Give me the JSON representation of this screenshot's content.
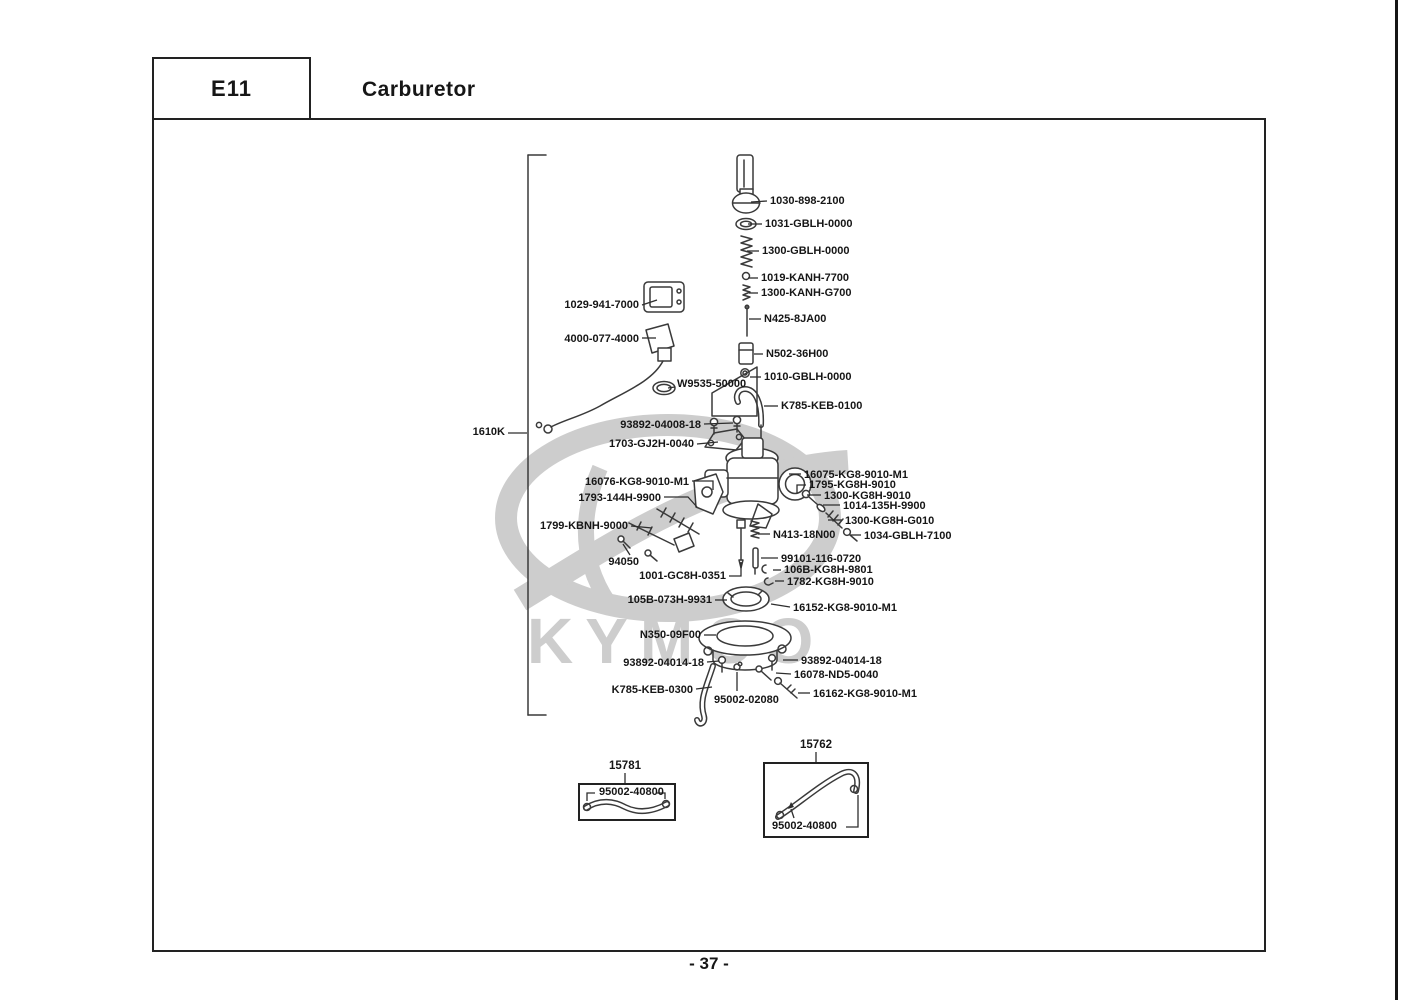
{
  "page": {
    "section_code": "E11",
    "title": "Carburetor",
    "page_number": "- 37 -",
    "watermark_text": "KYMCO"
  },
  "part_labels": [
    {
      "text": "1030-898-2100",
      "x": 770,
      "y": 195,
      "leader": [
        [
          767,
          201
        ],
        [
          751,
          202
        ]
      ]
    },
    {
      "text": "1031-GBLH-0000",
      "x": 765,
      "y": 218,
      "leader": [
        [
          762,
          224
        ],
        [
          748,
          224
        ]
      ]
    },
    {
      "text": "1300-GBLH-0000",
      "x": 762,
      "y": 245,
      "leader": [
        [
          759,
          251
        ],
        [
          747,
          251
        ]
      ]
    },
    {
      "text": "1019-KANH-7700",
      "x": 761,
      "y": 272,
      "leader": [
        [
          758,
          278
        ],
        [
          748,
          278
        ]
      ]
    },
    {
      "text": "1300-KANH-G700",
      "x": 761,
      "y": 287,
      "leader": [
        [
          758,
          293
        ],
        [
          749,
          293
        ]
      ]
    },
    {
      "text": "N425-8JA00",
      "x": 764,
      "y": 313,
      "leader": [
        [
          761,
          319
        ],
        [
          749,
          319
        ]
      ]
    },
    {
      "text": "N502-36H00",
      "x": 766,
      "y": 348,
      "leader": [
        [
          763,
          354
        ],
        [
          754,
          354
        ]
      ]
    },
    {
      "text": "1010-GBLH-0000",
      "x": 764,
      "y": 371,
      "leader": [
        [
          761,
          377
        ],
        [
          750,
          377
        ]
      ]
    },
    {
      "text": "K785-KEB-0100",
      "x": 781,
      "y": 400,
      "leader": [
        [
          778,
          406
        ],
        [
          764,
          406
        ]
      ]
    },
    {
      "text": "1029-941-7000",
      "x": 639,
      "y": 299,
      "align": "right",
      "leader": [
        [
          642,
          305
        ],
        [
          657,
          300
        ]
      ]
    },
    {
      "text": "4000-077-4000",
      "x": 639,
      "y": 333,
      "align": "right",
      "leader": [
        [
          642,
          338
        ],
        [
          656,
          338
        ]
      ]
    },
    {
      "text": "W9535-50000",
      "x": 677,
      "y": 378,
      "leader": [
        [
          675,
          387
        ],
        [
          668,
          388
        ]
      ]
    },
    {
      "text": "93892-04008-18",
      "x": 701,
      "y": 419,
      "align": "right",
      "leader": [
        [
          704,
          424
        ],
        [
          733,
          423
        ]
      ]
    },
    {
      "text": "1703-GJ2H-0040",
      "x": 694,
      "y": 438,
      "align": "right",
      "leader": [
        [
          697,
          444
        ],
        [
          718,
          442
        ]
      ]
    },
    {
      "text": "16076-KG8-9010-M1",
      "x": 689,
      "y": 476,
      "align": "right",
      "leader": [
        [
          692,
          481
        ],
        [
          713,
          481
        ],
        [
          713,
          490
        ]
      ]
    },
    {
      "text": "1793-144H-9900",
      "x": 661,
      "y": 492,
      "align": "right",
      "leader": [
        [
          664,
          497
        ],
        [
          688,
          497
        ],
        [
          697,
          507
        ]
      ]
    },
    {
      "text": "1799-KBNH-9000",
      "x": 628,
      "y": 520,
      "align": "right",
      "leader": [
        [
          631,
          526
        ],
        [
          652,
          528
        ]
      ]
    },
    {
      "text": "94050",
      "x": 639,
      "y": 556,
      "align": "right",
      "leader": [
        [
          630,
          555
        ],
        [
          623,
          544
        ]
      ]
    },
    {
      "text": "1001-GC8H-0351",
      "x": 726,
      "y": 570,
      "align": "right",
      "leader": [
        [
          729,
          576
        ],
        [
          741,
          576
        ],
        [
          741,
          562
        ]
      ]
    },
    {
      "text": "105B-073H-9931",
      "x": 712,
      "y": 594,
      "align": "right",
      "leader": [
        [
          715,
          600
        ],
        [
          727,
          600
        ]
      ]
    },
    {
      "text": "N350-09F00",
      "x": 701,
      "y": 629,
      "align": "right",
      "leader": [
        [
          704,
          635
        ],
        [
          716,
          635
        ]
      ]
    },
    {
      "text": "93892-04014-18",
      "x": 704,
      "y": 657,
      "align": "right",
      "leader": [
        [
          707,
          662
        ],
        [
          719,
          661
        ]
      ]
    },
    {
      "text": "K785-KEB-0300",
      "x": 693,
      "y": 684,
      "align": "right",
      "leader": [
        [
          696,
          689
        ],
        [
          712,
          687
        ]
      ]
    },
    {
      "text": "95002-02080",
      "x": 714,
      "y": 694,
      "leader": [
        [
          737,
          691
        ],
        [
          737,
          672
        ]
      ]
    },
    {
      "text": "16152-KG8-9010-M1",
      "x": 793,
      "y": 602,
      "leader": [
        [
          790,
          607
        ],
        [
          771,
          604
        ]
      ]
    },
    {
      "text": "93892-04014-18",
      "x": 801,
      "y": 655,
      "leader": [
        [
          798,
          660
        ],
        [
          783,
          660
        ]
      ]
    },
    {
      "text": "16078-ND5-0040",
      "x": 794,
      "y": 669,
      "leader": [
        [
          791,
          674
        ],
        [
          776,
          673
        ]
      ]
    },
    {
      "text": "16162-KG8-9010-M1",
      "x": 813,
      "y": 688,
      "leader": [
        [
          810,
          693
        ],
        [
          798,
          693
        ]
      ]
    },
    {
      "text": "16075-KG8-9010-M1",
      "x": 804,
      "y": 469,
      "leader": [
        [
          801,
          474
        ],
        [
          789,
          474
        ]
      ]
    },
    {
      "text": "1795-KG8H-9010",
      "x": 809,
      "y": 479,
      "leader": [
        [
          806,
          485
        ],
        [
          797,
          485
        ],
        [
          797,
          493
        ]
      ]
    },
    {
      "text": "1300-KG8H-9010",
      "x": 824,
      "y": 490,
      "leader": [
        [
          821,
          495
        ],
        [
          807,
          495
        ]
      ]
    },
    {
      "text": "1014-135H-9900",
      "x": 843,
      "y": 500,
      "leader": [
        [
          840,
          505
        ],
        [
          823,
          505
        ]
      ]
    },
    {
      "text": "1300-KG8H-G010",
      "x": 845,
      "y": 515,
      "leader": [
        [
          842,
          520
        ],
        [
          828,
          520
        ]
      ]
    },
    {
      "text": "1034-GBLH-7100",
      "x": 864,
      "y": 530,
      "leader": [
        [
          861,
          535
        ],
        [
          850,
          535
        ]
      ]
    },
    {
      "text": "N413-18N00",
      "x": 773,
      "y": 529,
      "leader": [
        [
          770,
          534
        ],
        [
          758,
          534
        ]
      ]
    },
    {
      "text": "99101-116-0720",
      "x": 781,
      "y": 553,
      "leader": [
        [
          778,
          558
        ],
        [
          761,
          558
        ]
      ]
    },
    {
      "text": "106B-KG8H-9801",
      "x": 784,
      "y": 564,
      "leader": [
        [
          781,
          570
        ],
        [
          773,
          570
        ]
      ]
    },
    {
      "text": "1782-KG8H-9010",
      "x": 787,
      "y": 576,
      "leader": [
        [
          784,
          581
        ],
        [
          775,
          581
        ]
      ]
    },
    {
      "text": "1610K",
      "x": 505,
      "y": 426,
      "align": "right",
      "leader": [
        [
          508,
          433
        ],
        [
          527,
          433
        ]
      ]
    }
  ],
  "insets": [
    {
      "ref": "15781",
      "part_number": "95002-40800",
      "ref_x": 625,
      "ref_y": 760,
      "box": [
        578,
        783,
        98,
        38
      ],
      "label_x": 599,
      "label_y": 786
    },
    {
      "ref": "15762",
      "part_number": "95002-40800",
      "ref_x": 816,
      "ref_y": 739,
      "box": [
        763,
        762,
        106,
        76
      ],
      "label_x": 772,
      "label_y": 820
    }
  ]
}
